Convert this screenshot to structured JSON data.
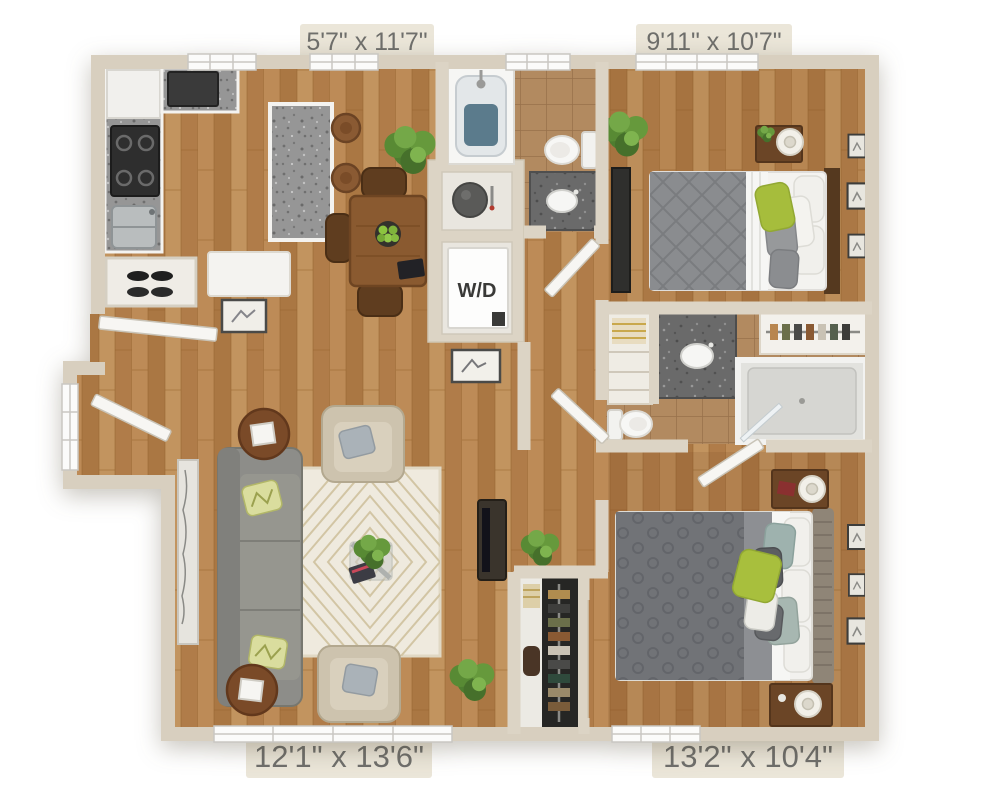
{
  "floorplan": {
    "rooms": {
      "kitchen_dining": {
        "dimensions": "5'7\" x 11'7\""
      },
      "bedroom_1": {
        "dimensions": "9'11\" x 10'7\""
      },
      "living_room": {
        "dimensions": "12'1\" x 13'6\""
      },
      "bedroom_2": {
        "dimensions": "13'2\" x 10'4\""
      }
    },
    "labels": {
      "washer_dryer": "W/D"
    },
    "colors": {
      "background": "#ffffff",
      "wall": "#dcd4c5",
      "wall_shadow": "#c9c0ac",
      "label_background": "#ebe6d9",
      "label_text": "#6f6f6c",
      "wood_floor": "#b5824e",
      "tile_floor": "#b28a60",
      "granite": "#969696",
      "granite_dark": "#6a6a6a",
      "fixture_white": "#f6f6f4",
      "sofa_gray": "#8d8d89",
      "bed_gray": "#8a8c8f",
      "accent_green": "#a8bf3d",
      "plant_green": "#4e7d30",
      "wood_furniture": "#6b4526"
    }
  }
}
